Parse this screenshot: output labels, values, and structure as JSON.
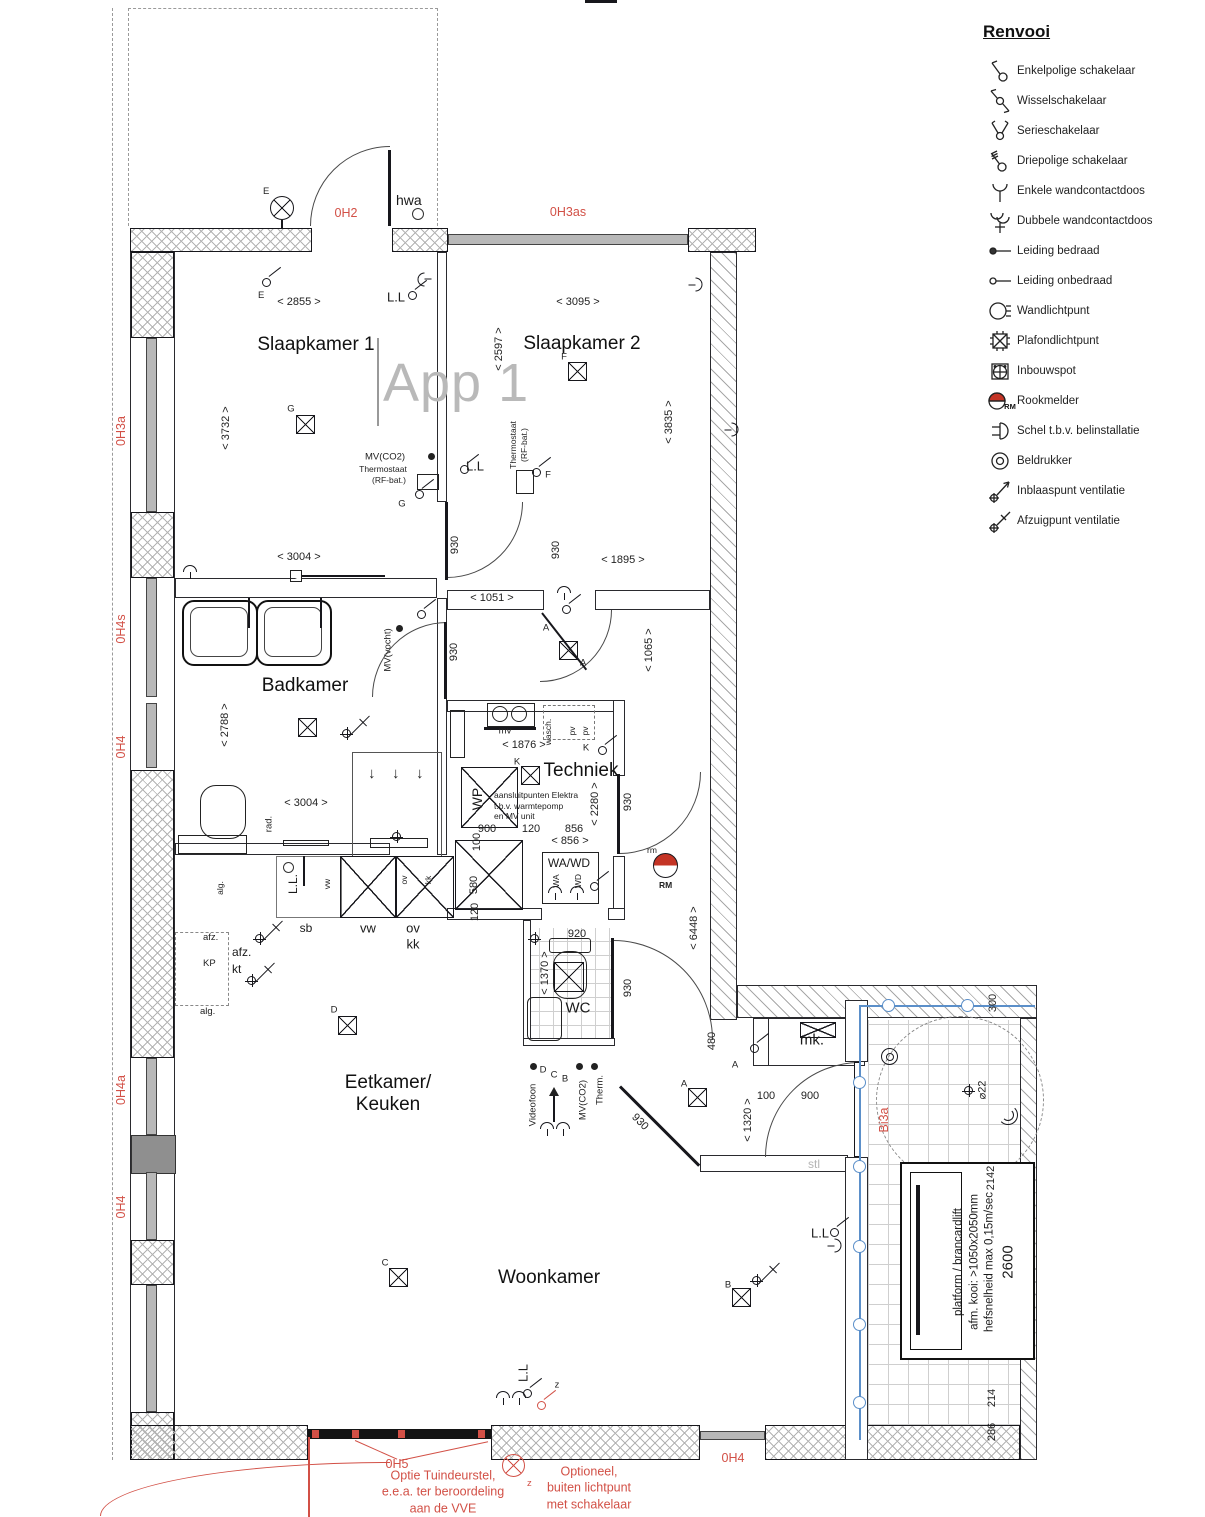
{
  "watermark": "App 1",
  "colors": {
    "accent_red": "#d25046",
    "plumbing_blue": "#5b8fc9",
    "smoke_red": "#c43425"
  },
  "legend": {
    "title": "Renvooi",
    "items": [
      {
        "icon": "single-pole-switch-icon",
        "label": "Enkelpolige schakelaar"
      },
      {
        "icon": "two-way-switch-icon",
        "label": "Wisselschakelaar"
      },
      {
        "icon": "series-switch-icon",
        "label": "Serieschakelaar"
      },
      {
        "icon": "three-pole-switch-icon",
        "label": "Driepolige schakelaar"
      },
      {
        "icon": "single-socket-icon",
        "label": "Enkele wandcontactdoos"
      },
      {
        "icon": "double-socket-icon",
        "label": "Dubbele wandcontactdoos"
      },
      {
        "icon": "wired-conduit-icon",
        "label": "Leiding bedraad"
      },
      {
        "icon": "unwired-conduit-icon",
        "label": "Leiding onbedraad"
      },
      {
        "icon": "wall-light-icon",
        "label": "Wandlichtpunt"
      },
      {
        "icon": "ceiling-light-icon",
        "label": "Plafondlichtpunt"
      },
      {
        "icon": "recessed-spot-icon",
        "label": "Inbouwspot"
      },
      {
        "icon": "smoke-detector-icon",
        "label": "Rookmelder"
      },
      {
        "icon": "doorbell-chime-icon",
        "label": "Schel t.b.v. belinstallatie"
      },
      {
        "icon": "bell-push-icon",
        "label": "Beldrukker"
      },
      {
        "icon": "supply-vent-icon",
        "label": "Inblaaspunt ventilatie"
      },
      {
        "icon": "extract-vent-icon",
        "label": "Afzuigpunt ventilatie"
      }
    ]
  },
  "rooms": {
    "slaapkamer1": "Slaapkamer 1",
    "slaapkamer2": "Slaapkamer 2",
    "badkamer": "Badkamer",
    "techniek": "Techniek",
    "eetkamer_line1": "Eetkamer/",
    "eetkamer_line2": "Keuken",
    "woonkamer": "Woonkamer",
    "wc": "WC",
    "mk": "mk."
  },
  "red": {
    "oh2": "0H2",
    "oh3as": "0H3as",
    "oh3a": "0H3a",
    "oh4s": "0H4s",
    "oh4": "0H4",
    "oh4a": "0H4a",
    "oh5": "0H5",
    "oh4_bottom": "0H4",
    "bi3a": "Bi3a",
    "note_tuindeur": "Optie Tuindeurstel,\ne.e.a. ter beroordeling\naan de VVE",
    "note_buitenlicht": "Optioneel,\nbuiten lichtpunt\nmet schakelaar"
  },
  "dims": {
    "d2855": "< 2855 >",
    "d3732": "< 3732 >",
    "d3095": "< 3095 >",
    "d2597": "< 2597 >",
    "d3835": "< 3835 >",
    "d3004": "< 3004 >",
    "d1051": "< 1051 >",
    "d1895": "< 1895 >",
    "d1065": "< 1065 >",
    "d2788": "< 2788 >",
    "d1876": "< 1876 >",
    "d2280": "< 2280 >",
    "d930": "930",
    "d920": "920",
    "d1370": "< 1370 >",
    "d6448": "< 6448 >",
    "d900": "900",
    "d120": "120",
    "d856": "856",
    "d856_arrows": "< 856 >",
    "d580": "580",
    "d100": "100",
    "d480": "480",
    "d1320": "< 1320 >",
    "d300": "300",
    "d2142": "2142",
    "d2600": "2600",
    "d286": "286",
    "d214": "214",
    "d_diam22": "⌀22"
  },
  "l": {
    "hwa": "hwa",
    "ll": "L.L",
    "ll_dot": "L.L.",
    "e": "E",
    "g": "G",
    "f": "F",
    "a": "A",
    "b": "B",
    "c": "C",
    "d": "D",
    "k": "K",
    "z": "z",
    "rm_sub": "RM",
    "rm_top": "rm",
    "mv_co2": "MV(CO2)",
    "thermostaat": "Thermostaat",
    "rf_bat": "(RF-bat.)",
    "mv_vocht": "MV(vocht)",
    "rad": "rad.",
    "mv": "mv",
    "wasch": "wasch.",
    "pv": "pv",
    "wp": "WP",
    "aansluit": "aansluitpunten Elektra\nt.b.v. warmtepomp\nen MV unit",
    "wawd": "WA/WD",
    "wa": "WA",
    "wd": "WD",
    "sb": "sb",
    "vw": "vw",
    "ov": "ov",
    "kk": "kk",
    "afz": "afz.",
    "kt": "kt",
    "kp": "KP",
    "alg": "alg.",
    "videofoon": "Videofoon",
    "therm": "Therm.",
    "stl": "stl"
  },
  "lift": {
    "line1": "platform / brancardlift",
    "line2": "afm. kooi: >1050x2050mm",
    "line3": "hefsnelheid max 0,15m/sec",
    "size": "2600"
  }
}
